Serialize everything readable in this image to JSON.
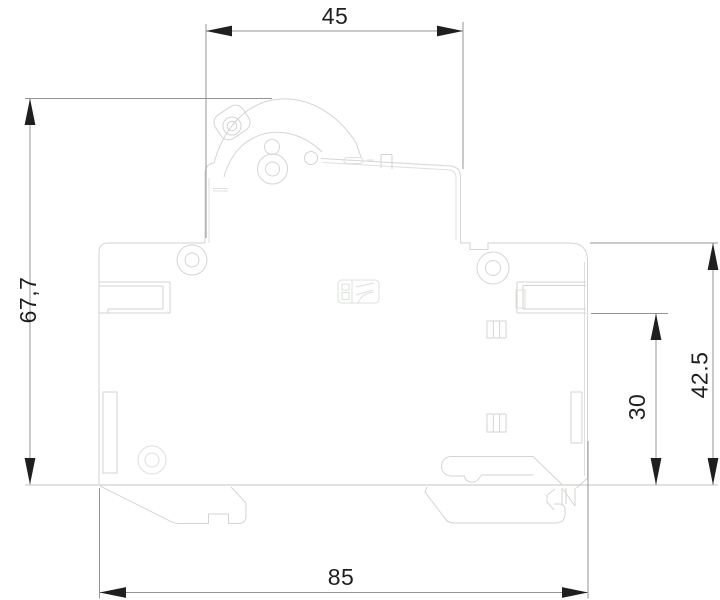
{
  "drawing": {
    "title": "breaker-side-profile-dimension-drawing",
    "dimensions": {
      "top_width": "45",
      "overall_height": "67,7",
      "upper_height": "42.5",
      "lower_height": "30",
      "overall_depth": "85"
    },
    "colors": {
      "outline": "#d2d6d1",
      "dimension_lines": "#949494",
      "dimension_text": "#1f1f1f",
      "background": "#ffffff"
    }
  }
}
